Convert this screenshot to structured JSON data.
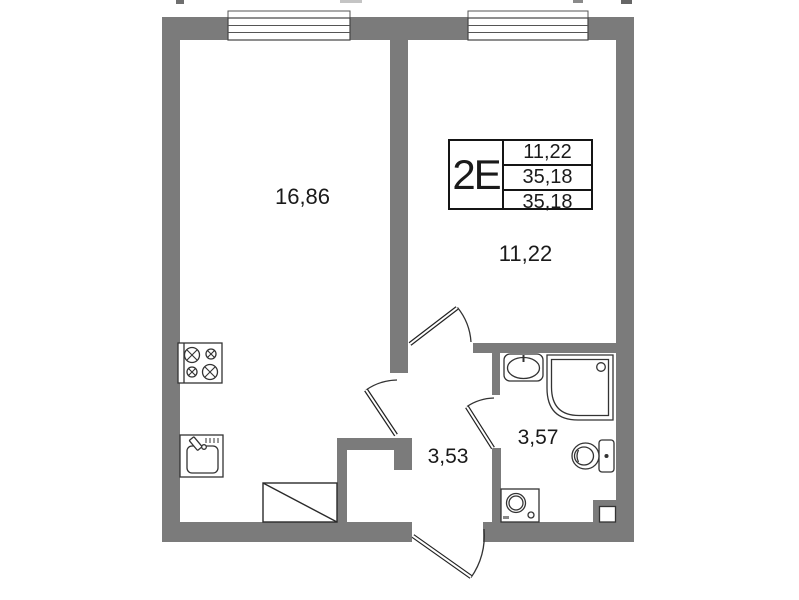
{
  "plan": {
    "title": "apartment-floor-plan",
    "info_table": {
      "type_label": "2Е",
      "rows": [
        "11,22",
        "35,18",
        "35,18"
      ]
    },
    "rooms": {
      "living": {
        "area": "16,86"
      },
      "bedroom": {
        "area": "11,22"
      },
      "hallway": {
        "area": "3,53"
      },
      "bathroom": {
        "area": "3,57"
      }
    },
    "icons": [
      "stove-icon",
      "kitchen-sink-icon",
      "wardrobe-icon",
      "washbasin-icon",
      "shower-cabin-icon",
      "toilet-icon",
      "washing-machine-icon",
      "vent-shaft-icon",
      "window-icon",
      "door-swing-icon"
    ],
    "colors": {
      "wall": "#7b7b7b",
      "line": "#333333",
      "text": "#1a1a1a",
      "background": "#ffffff"
    }
  }
}
